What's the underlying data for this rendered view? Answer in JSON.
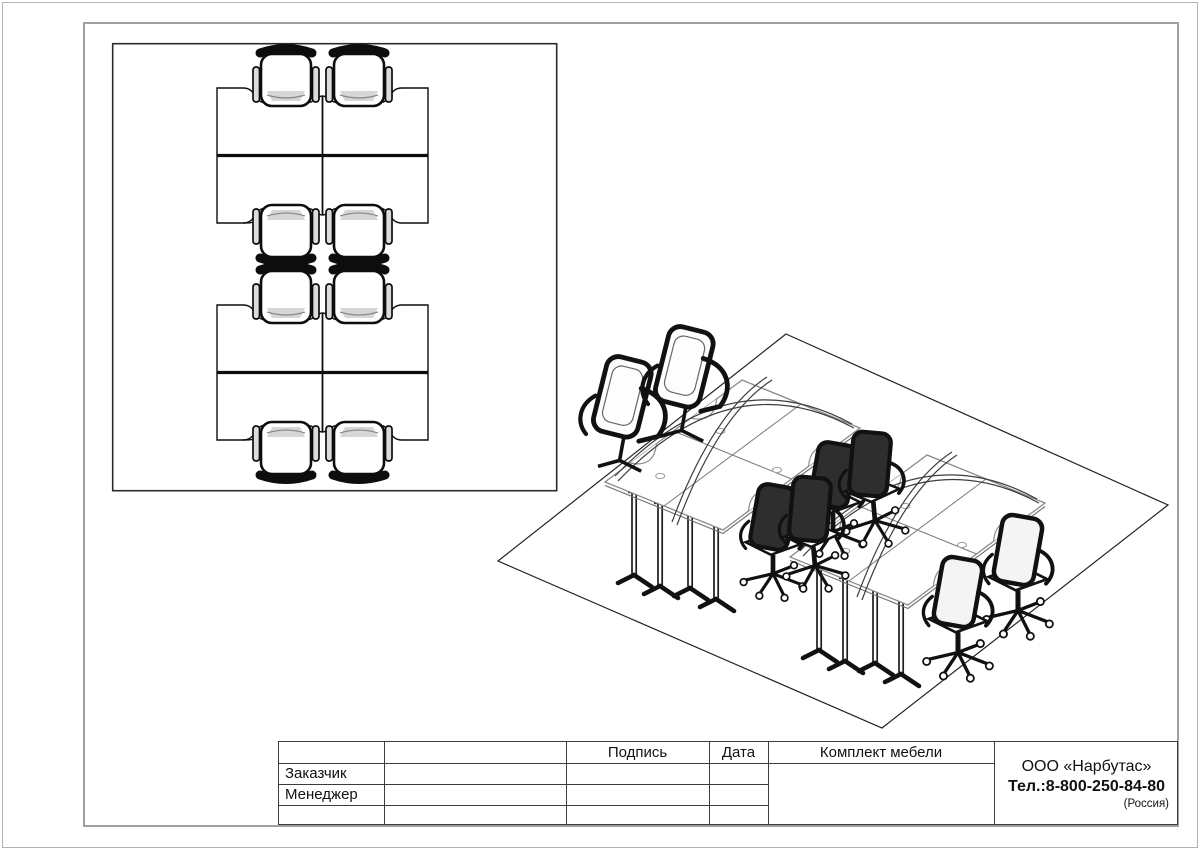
{
  "document": {
    "kind": "office furniture arrangement drawing",
    "views": {
      "plan": {
        "clusters": 2,
        "desks_per_cluster": 4,
        "chairs_per_cluster": 4
      },
      "isometric": {
        "clusters": 2,
        "desks": 8,
        "chairs": 8
      }
    },
    "colors": {
      "line": "#1a1a1a",
      "frame_gray": "#a0a0a0",
      "table_line": "#3c3c3c"
    }
  },
  "title_block": {
    "headers": {
      "signature": "Подпись",
      "date": "Дата",
      "furniture_set": "Комплект мебели"
    },
    "rows": {
      "customer": "Заказчик",
      "manager": "Менеджер"
    },
    "company": {
      "name": "ООО «Нарбутас»",
      "phone": "Тел.:8-800-250-84-80",
      "country": "(Россия)"
    }
  }
}
